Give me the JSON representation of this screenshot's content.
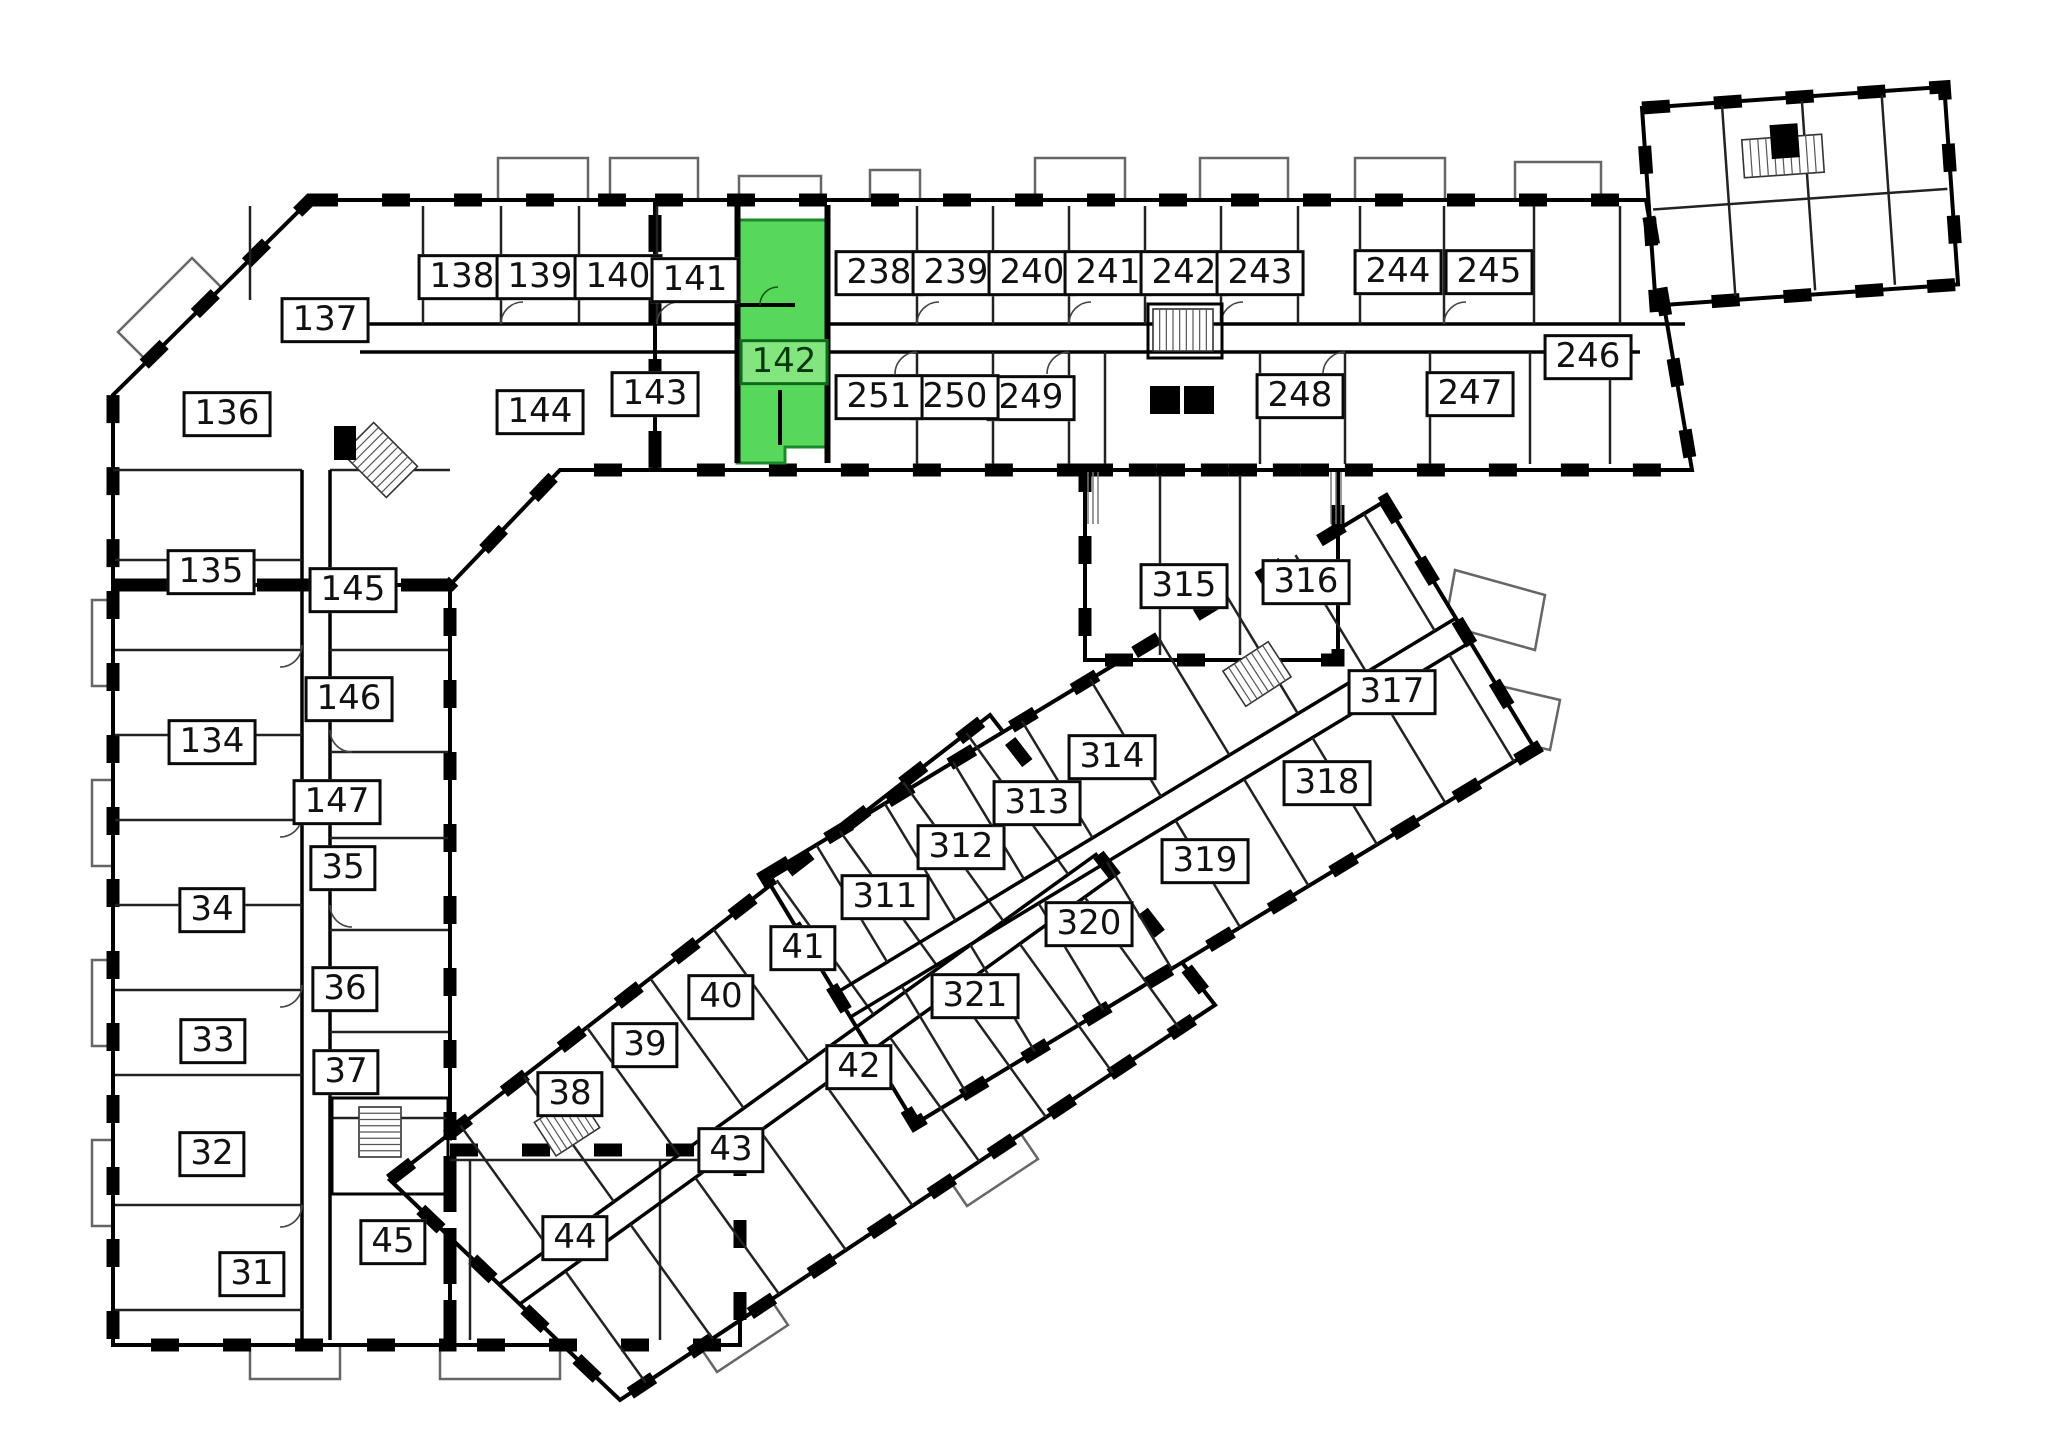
{
  "floor_plan": {
    "background_color": "#ffffff",
    "wall_color": "#000000",
    "thin_line_color": "#444444",
    "balcony_line_color": "#666666",
    "highlight": {
      "room": "142",
      "fill": "#58d85a",
      "border": "#1c8a28",
      "label_fill": "#83e57e",
      "label_border": "#0e6b1c",
      "label_text_color": "#07360d",
      "polygon": "737,220 828,220 828,447 785,447 785,463 737,463"
    },
    "rooms": [
      {
        "id": "138",
        "x": 462,
        "y": 277
      },
      {
        "id": "139",
        "x": 540,
        "y": 277
      },
      {
        "id": "140",
        "x": 618,
        "y": 277
      },
      {
        "id": "141",
        "x": 695,
        "y": 280
      },
      {
        "id": "142",
        "x": 784,
        "y": 362,
        "selected": true
      },
      {
        "id": "238",
        "x": 879,
        "y": 273
      },
      {
        "id": "239",
        "x": 956,
        "y": 273
      },
      {
        "id": "240",
        "x": 1032,
        "y": 273
      },
      {
        "id": "241",
        "x": 1108,
        "y": 273
      },
      {
        "id": "242",
        "x": 1184,
        "y": 273
      },
      {
        "id": "243",
        "x": 1260,
        "y": 273
      },
      {
        "id": "244",
        "x": 1398,
        "y": 272
      },
      {
        "id": "245",
        "x": 1489,
        "y": 272
      },
      {
        "id": "246",
        "x": 1588,
        "y": 357
      },
      {
        "id": "247",
        "x": 1470,
        "y": 394
      },
      {
        "id": "248",
        "x": 1300,
        "y": 396
      },
      {
        "id": "249",
        "x": 1031,
        "y": 398
      },
      {
        "id": "250",
        "x": 955,
        "y": 397
      },
      {
        "id": "251",
        "x": 879,
        "y": 397
      },
      {
        "id": "137",
        "x": 325,
        "y": 320
      },
      {
        "id": "136",
        "x": 227,
        "y": 414
      },
      {
        "id": "144",
        "x": 540,
        "y": 412
      },
      {
        "id": "143",
        "x": 655,
        "y": 394
      },
      {
        "id": "135",
        "x": 211,
        "y": 572
      },
      {
        "id": "145",
        "x": 353,
        "y": 590
      },
      {
        "id": "146",
        "x": 349,
        "y": 699
      },
      {
        "id": "134",
        "x": 212,
        "y": 742
      },
      {
        "id": "147",
        "x": 337,
        "y": 802
      },
      {
        "id": "35",
        "x": 343,
        "y": 868
      },
      {
        "id": "34",
        "x": 212,
        "y": 910
      },
      {
        "id": "36",
        "x": 345,
        "y": 989
      },
      {
        "id": "33",
        "x": 213,
        "y": 1041
      },
      {
        "id": "37",
        "x": 346,
        "y": 1072
      },
      {
        "id": "32",
        "x": 212,
        "y": 1154
      },
      {
        "id": "31",
        "x": 252,
        "y": 1274
      },
      {
        "id": "45",
        "x": 393,
        "y": 1242
      },
      {
        "id": "44",
        "x": 575,
        "y": 1238
      },
      {
        "id": "38",
        "x": 570,
        "y": 1094
      },
      {
        "id": "39",
        "x": 645,
        "y": 1045
      },
      {
        "id": "40",
        "x": 721,
        "y": 997
      },
      {
        "id": "41",
        "x": 803,
        "y": 948
      },
      {
        "id": "42",
        "x": 859,
        "y": 1067
      },
      {
        "id": "43",
        "x": 731,
        "y": 1150
      },
      {
        "id": "311",
        "x": 885,
        "y": 897
      },
      {
        "id": "312",
        "x": 961,
        "y": 847
      },
      {
        "id": "313",
        "x": 1037,
        "y": 803
      },
      {
        "id": "314",
        "x": 1112,
        "y": 757
      },
      {
        "id": "321",
        "x": 975,
        "y": 996
      },
      {
        "id": "320",
        "x": 1089,
        "y": 924
      },
      {
        "id": "319",
        "x": 1205,
        "y": 861
      },
      {
        "id": "318",
        "x": 1327,
        "y": 783
      },
      {
        "id": "317",
        "x": 1392,
        "y": 692
      },
      {
        "id": "315",
        "x": 1184,
        "y": 586
      },
      {
        "id": "316",
        "x": 1306,
        "y": 582
      }
    ]
  }
}
